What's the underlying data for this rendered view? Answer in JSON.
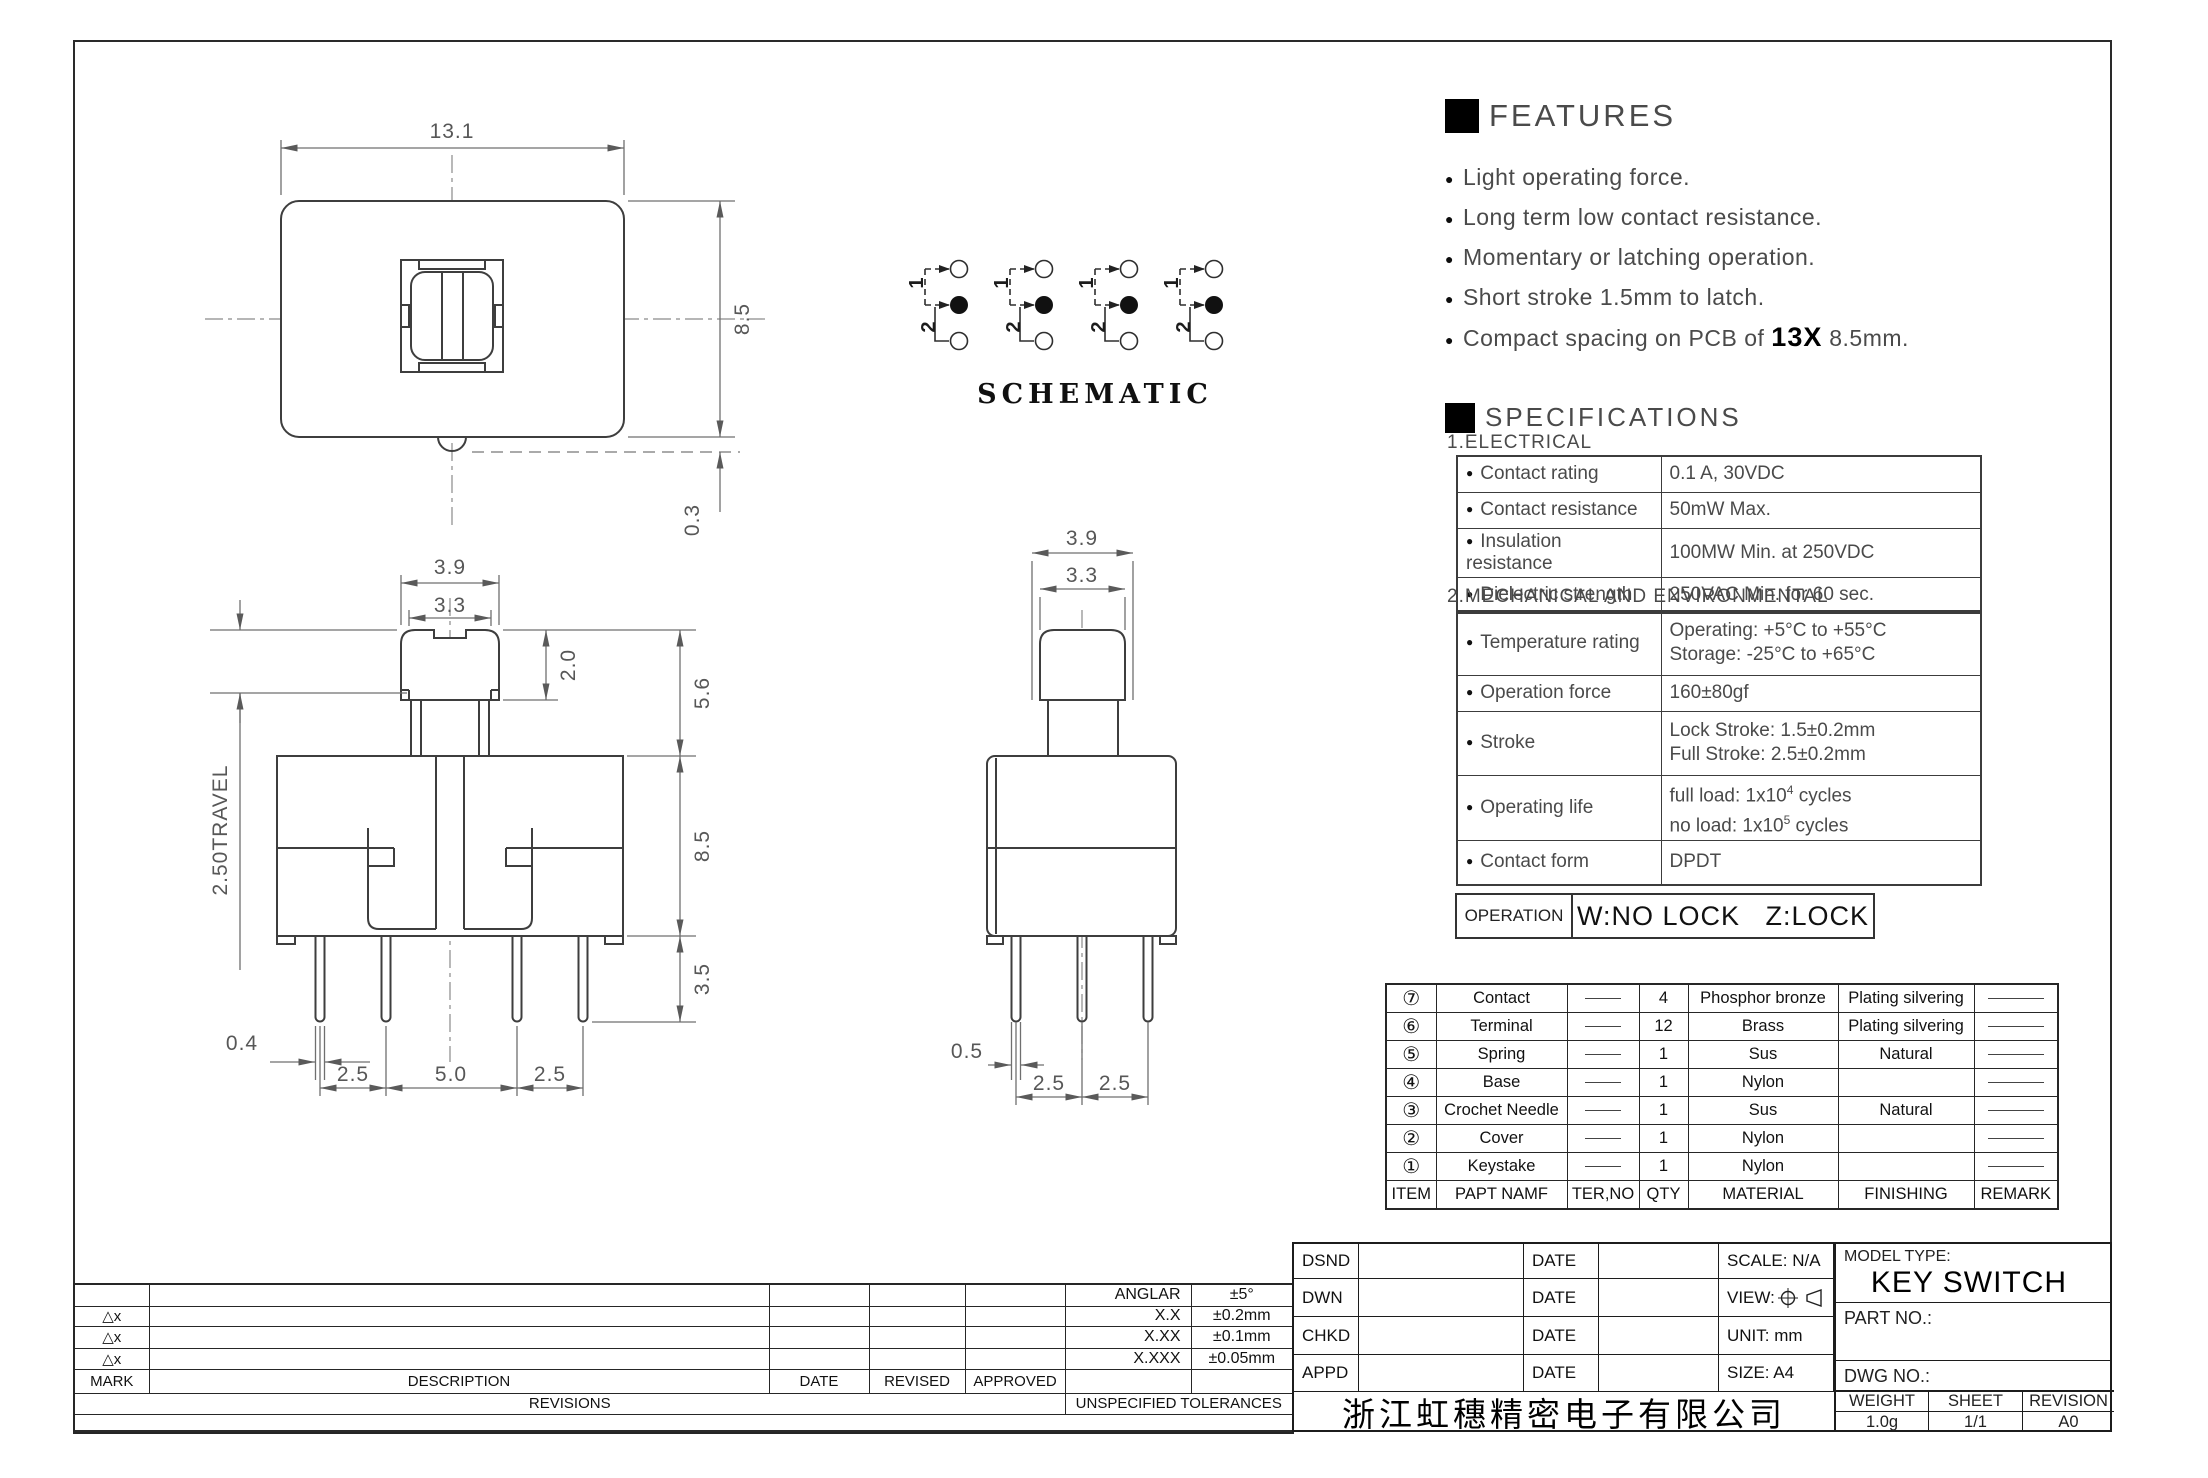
{
  "features": {
    "title": "FEATURES",
    "items": [
      "Light operating force.",
      "Long term low contact resistance.",
      "Momentary or latching operation.",
      "Short stroke 1.5mm to latch."
    ],
    "item5": {
      "prefix": "Compact spacing on PCB of ",
      "bold": "13X",
      "suffix": " 8.5mm."
    }
  },
  "schematic": {
    "label": "SCHEMATIC",
    "pole1": "1",
    "pole2": "2"
  },
  "dims": {
    "top_view": {
      "width": "13.1",
      "height": "8.5",
      "offset": "0.3"
    },
    "front_view": {
      "cap_width": "3.9",
      "cap_top_width": "3.3",
      "cap_height": "2.0",
      "upper_height": "5.6",
      "body_height": "8.5",
      "pin_length": "3.5",
      "travel": "2.50TRAVEL",
      "pin_width": "0.4",
      "pin_pitch": [
        "2.5",
        "5.0",
        "2.5"
      ]
    },
    "side_view": {
      "cap_width": "3.9",
      "cap_top_width": "3.3",
      "pin_width": "0.5",
      "pin_pitch": [
        "2.5",
        "2.5"
      ]
    }
  },
  "specifications": {
    "title": "SPECIFICATIONS",
    "electrical": {
      "heading": "1.ELECTRICAL",
      "rows": [
        {
          "label": "Contact rating",
          "value": "0.1 A, 30VDC"
        },
        {
          "label": "Contact resistance",
          "value": "50mW Max."
        },
        {
          "label": "Insulation resistance",
          "value": "100MW Min. at 250VDC"
        },
        {
          "label": "Dielectric strength",
          "value": "250VAC Min. for 60 sec."
        }
      ]
    },
    "mechanical": {
      "heading": "2.MECHANICAL AND ENVIRONMENTAL",
      "rows": [
        {
          "label": "Temperature rating",
          "value1": "Operating: +5°C to +55°C",
          "value2": "Storage: -25°C to +65°C"
        },
        {
          "label": "Operation force",
          "value1": "160±80gf",
          "value2": ""
        },
        {
          "label": "Stroke",
          "value1": "Lock Stroke: 1.5±0.2mm",
          "value2": "Full Stroke: 2.5±0.2mm"
        },
        {
          "label": "Operating life",
          "value1_pre": "full load: 1x10",
          "value1_sup": "4",
          "value1_post": " cycles",
          "value2_pre": "no load: 1x10",
          "value2_sup": "5",
          "value2_post": " cycles"
        },
        {
          "label": "Contact form",
          "value1": "DPDT",
          "value2": ""
        }
      ]
    }
  },
  "operation": {
    "label": "OPERATION",
    "value": "W:NO LOCK   Z:LOCK"
  },
  "parts_table": {
    "headers": [
      "ITEM",
      "PAPT NAMF",
      "TER,NO",
      "QTY",
      "MATERIAL",
      "FINISHING",
      "REMARK"
    ],
    "rows": [
      {
        "item": "⑦",
        "name": "Contact",
        "qty": "4",
        "material": "Phosphor bronze",
        "finishing": "Plating silvering"
      },
      {
        "item": "⑥",
        "name": "Terminal",
        "qty": "12",
        "material": "Brass",
        "finishing": "Plating silvering"
      },
      {
        "item": "⑤",
        "name": "Spring",
        "qty": "1",
        "material": "Sus",
        "finishing": "Natural"
      },
      {
        "item": "④",
        "name": "Base",
        "qty": "1",
        "material": "Nylon",
        "finishing": ""
      },
      {
        "item": "③",
        "name": "Crochet Needle",
        "qty": "1",
        "material": "Sus",
        "finishing": "Natural"
      },
      {
        "item": "②",
        "name": "Cover",
        "qty": "1",
        "material": "Nylon",
        "finishing": ""
      },
      {
        "item": "①",
        "name": "Keystake",
        "qty": "1",
        "material": "Nylon",
        "finishing": ""
      }
    ]
  },
  "tolerance_block": {
    "mark_symbol": "△x",
    "headers": [
      "MARK",
      "DESCRIPTION",
      "DATE",
      "REVISED",
      "APPROVED"
    ],
    "revisions_label": "REVISIONS",
    "tolerances_label": "UNSPECIFIED TOLERANCES",
    "tolerances": [
      {
        "label": "ANGLAR",
        "value": "±5°"
      },
      {
        "label": "X.X",
        "value": "±0.2mm"
      },
      {
        "label": "X.XX",
        "value": "±0.1mm"
      },
      {
        "label": "X.XXX",
        "value": "±0.05mm"
      }
    ]
  },
  "title_block": {
    "rows": [
      {
        "label": "DSND",
        "date_label": "DATE",
        "right": "SCALE: N/A"
      },
      {
        "label": "DWN",
        "date_label": "DATE",
        "right": "VIEW:"
      },
      {
        "label": "CHKD",
        "date_label": "DATE",
        "right": "UNIT: mm"
      },
      {
        "label": "APPD",
        "date_label": "DATE",
        "right": "SIZE: A4"
      }
    ],
    "company": "浙江虹穗精密电子有限公司",
    "model_type_label": "MODEL TYPE:",
    "model_type": "KEY SWITCH",
    "part_no_label": "PART NO.:",
    "dwg_no_label": "DWG NO.:",
    "weight_label": "WEIGHT",
    "weight_value": "1.0g",
    "sheet_label": "SHEET",
    "sheet_value": "1/1",
    "revision_label": "REVISION",
    "revision_value": "A0"
  }
}
